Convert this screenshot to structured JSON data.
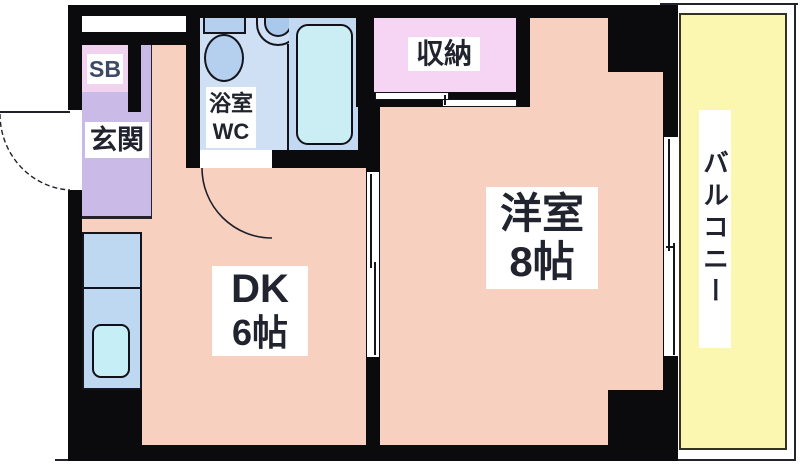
{
  "floorplan": {
    "title": "1DK apartment floor plan",
    "rooms": {
      "genkan": {
        "label": "玄関"
      },
      "shoe_box": {
        "label": "SB"
      },
      "bath_wc": {
        "line1": "浴室",
        "line2": "WC"
      },
      "storage": {
        "label": "収納"
      },
      "dining_kitchen": {
        "label": "DK",
        "size": "6帖"
      },
      "western_room": {
        "label": "洋室",
        "size": "8帖"
      },
      "balcony": {
        "label": "バルコニー"
      }
    },
    "colors": {
      "wall": "#0b0b0d",
      "dk_salmon": "#f7d0c0",
      "genkan_lavender": "#c9bae8",
      "shoe_box_pink": "#f2d3ef",
      "storage_pink": "#f6d4f3",
      "bathroom_blue": "#cfdff4",
      "fixture_blue": "#b5d0ef",
      "bathtub_cyan": "#cbeef5",
      "counter_blue": "#bed8f2",
      "sink_cyan": "#c5eef6",
      "balcony_yellow": "#fbf7b0",
      "label_text": "#21242f"
    }
  }
}
